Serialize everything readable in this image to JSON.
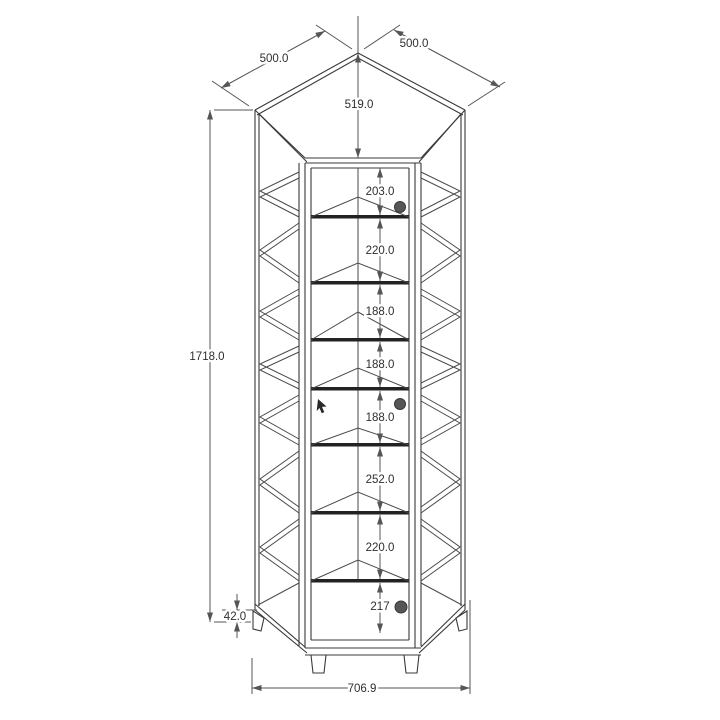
{
  "drawing": {
    "subject": "corner display cabinet dimensioned drawing",
    "view": "front elevation with projected shelves"
  },
  "dimensions": {
    "side_width_left": "500.0",
    "side_width_right": "500.0",
    "depth_to_corner": "519.0",
    "overall_height": "1718.0",
    "foot_height": "42.0",
    "overall_width": "706.9",
    "shelf_spacings": [
      "203.0",
      "220.0",
      "188.0",
      "188.0",
      "188.0",
      "252.0",
      "220.0",
      "217"
    ]
  },
  "colors": {
    "background": "#ffffff",
    "structure_line": "#3a3a3a",
    "shelf_line": "#222222",
    "dimension_line": "#555555",
    "knob": "#565656"
  }
}
